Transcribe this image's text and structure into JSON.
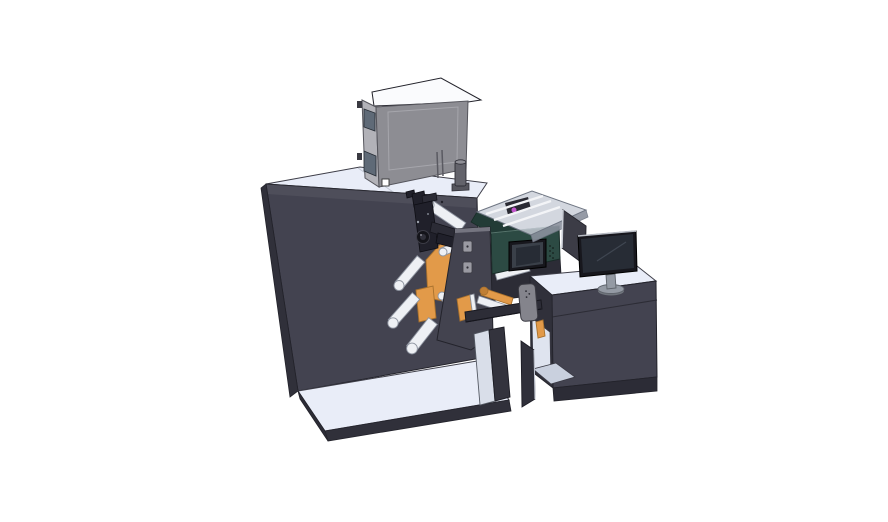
{
  "scene": {
    "description": "3D CAD isometric render of an industrial label printing / rewinding machine line on a white background",
    "view": "isometric three-quarter view",
    "background": "#ffffff"
  },
  "palette": {
    "bg": "#ffffff",
    "surface-light": "#e9edf8",
    "box-top": "#fafbfd",
    "charcoal": "#434350",
    "charcoal-dark": "#30303a",
    "charcoal-darker": "#2c2c36",
    "box-front": "#8d8d93",
    "box-side": "#b2b2b8",
    "window-glass": "#5f6a77",
    "teal": "#2c4a43",
    "teal-dark": "#223b36",
    "teal-edge": "#182b27",
    "orange": "#e29a49",
    "orange-edge": "#a8712d",
    "roller": "#eef0f4",
    "roller-edge": "#8e94a0",
    "mech": "#20202a",
    "mech-light": "#2b2b35",
    "cover-plate": "#43434f",
    "device-gray": "#84848c",
    "monitor-bezel": "#17171d",
    "monitor-screen": "#272c35",
    "stand-gray": "#949aa4",
    "cover-glass": "#c9ced8",
    "magenta": "#c355cc",
    "bay-light": "#dfe4ef",
    "bay-floor": "#c9d0de",
    "edge-dark": "#23232b",
    "edge-mid": "#3e3e48",
    "edge-box": "#55555c"
  },
  "parts": {
    "main_cabinet": "main machine cabinet (dark enclosure with light top)",
    "base_platform": "front base platform",
    "feeder_box": "gray electrical / feeder box with vent slots and side windows",
    "canister": "small cylindrical canister on cabinet top",
    "unwind_assembly": "unwind assembly with orange side plates, white guide rollers and black print mechanism",
    "cover_plate": "dark front cover plate of unwind assembly",
    "print_module": "teal print module with HMI touchscreen and transparent cover",
    "hmi_screen": "small HMI display on teal module",
    "transparent_cover": "translucent hood with internal carriage and rails",
    "magenta_element": "magenta internal component under hood",
    "output_section": "output / rewind section with orange roller, rail, sensor device and support legs",
    "operator_desk": "operator desk cabinet with open side bay",
    "monitor": "desktop monitor on round stand",
    "side_panel": "flat dark panel behind monitor"
  }
}
